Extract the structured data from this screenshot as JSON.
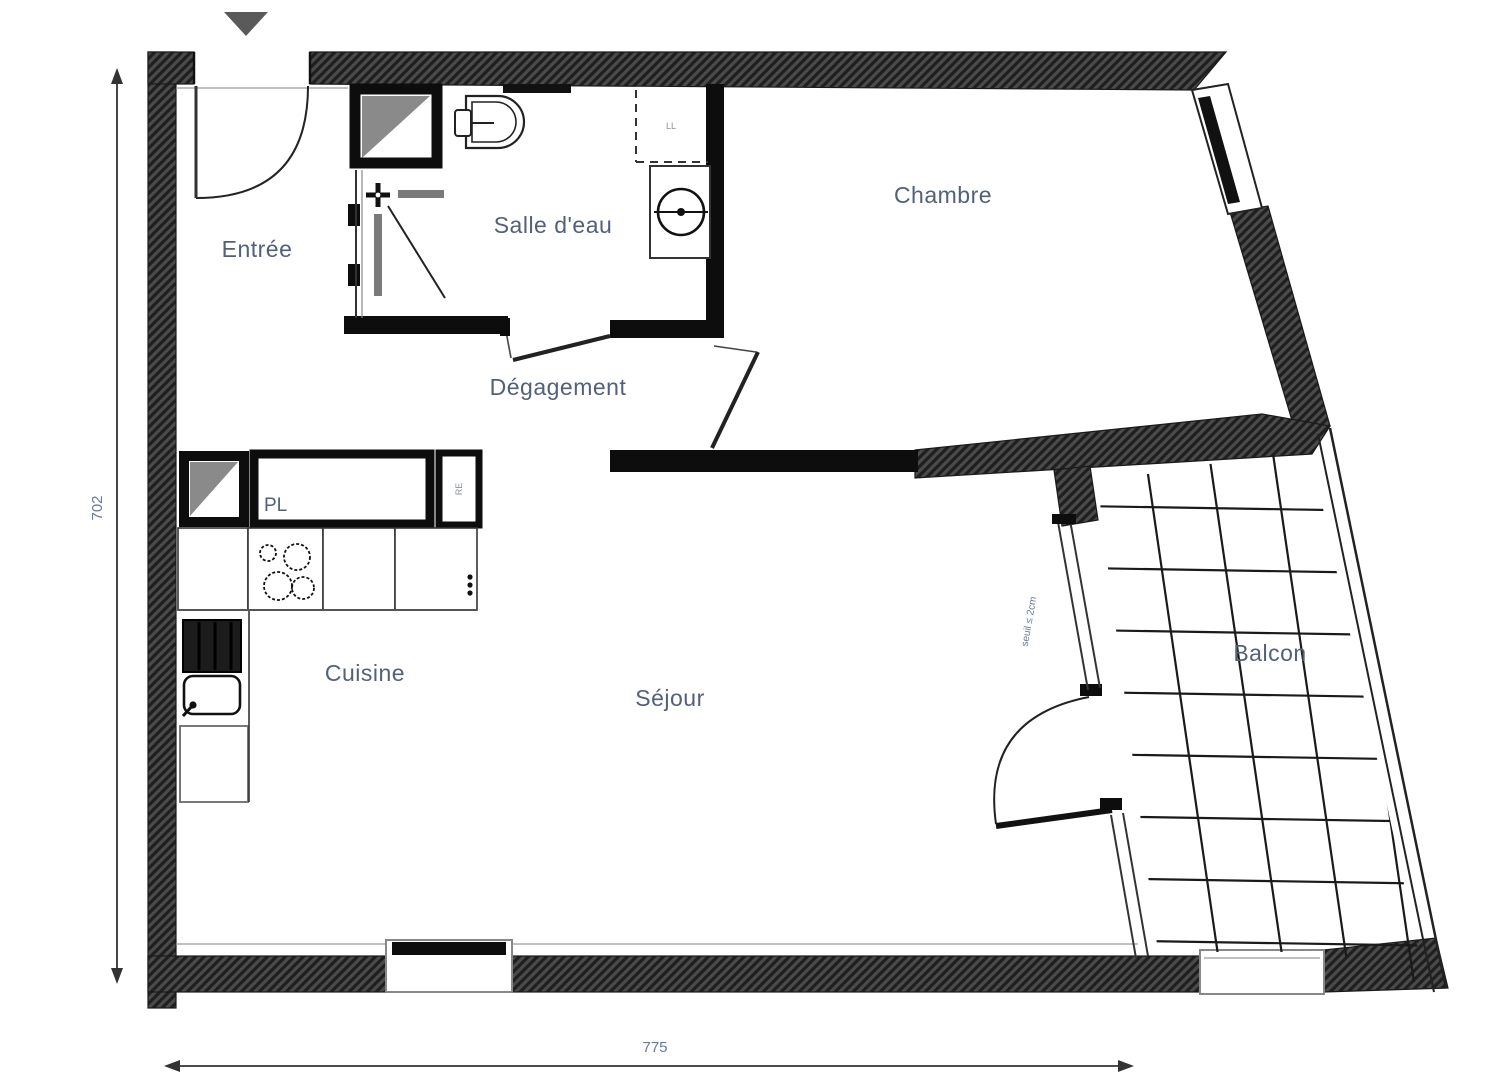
{
  "rooms": {
    "entree": {
      "label": "Entrée"
    },
    "salle_deau": {
      "label": "Salle d'eau"
    },
    "chambre": {
      "label": "Chambre"
    },
    "degagement": {
      "label": "Dégagement"
    },
    "cuisine": {
      "label": "Cuisine"
    },
    "sejour": {
      "label": "Séjour"
    },
    "balcon": {
      "label": "Balcon"
    },
    "placard": {
      "label": "PL"
    }
  },
  "annotations": {
    "washing_machine": "LL",
    "fridge": "RE",
    "threshold": "seuil ≤ 2cm"
  },
  "dimensions": {
    "height_cm": "702",
    "width_cm": "775"
  },
  "colors": {
    "wall_fill": "#4a4a4a",
    "wall_hatch": "#1f1f1f",
    "partition": "#0d0d0d",
    "label": "#52607c",
    "dimension": "#67789a",
    "line": "#222222"
  }
}
